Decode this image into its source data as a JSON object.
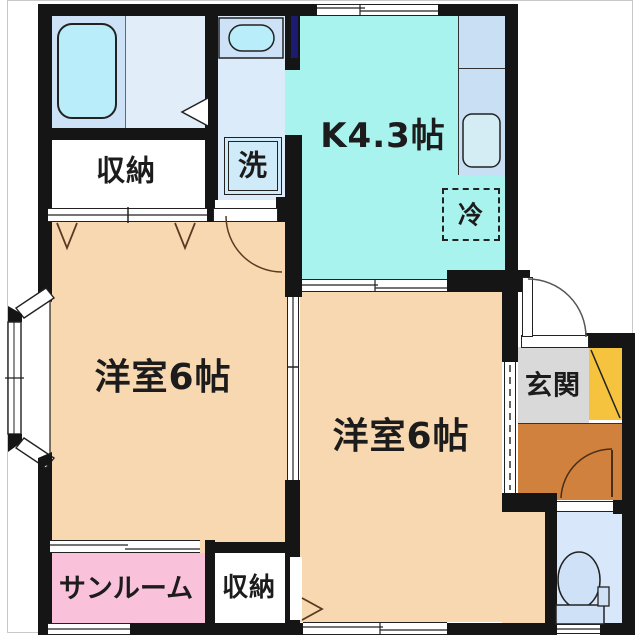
{
  "plan_type": "apartment-floorplan",
  "rooms": {
    "kitchen": {
      "label": "K4.3帖"
    },
    "room_left": {
      "label": "洋室6帖"
    },
    "room_right": {
      "label": "洋室6帖"
    },
    "storage_top": {
      "label": "収納"
    },
    "storage_bottom": {
      "label": "収納"
    },
    "sunroom": {
      "label": "サンルーム"
    },
    "entrance": {
      "label": "玄関"
    },
    "washing_machine": {
      "label": "洗"
    },
    "refrigerator": {
      "label": "冷"
    }
  },
  "colors": {
    "wall": "#151515",
    "kitchen_floor": "#a9f3ef",
    "western_room_floor": "#f8d8b0",
    "sunroom_floor": "#f9c2da",
    "entrance_floor": "#d9d9d9",
    "hall_floor": "#d0813e",
    "shoe_cabinet": "#f6c33e",
    "bathroom_floor": "#cde2f6",
    "washroom_floor": "#dcebf9",
    "toilet_floor": "#d8e8fa",
    "kitchen_counter": "#c9dff4",
    "fixture_fill": "#b9edf9",
    "window_glass": "#1b1b72"
  }
}
